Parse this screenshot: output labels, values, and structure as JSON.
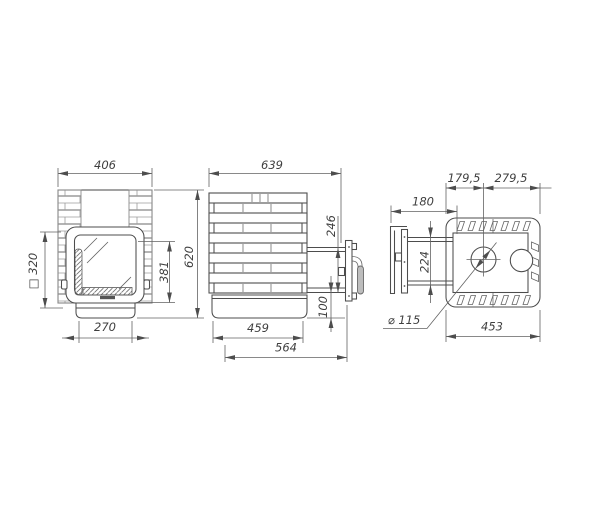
{
  "dims": {
    "front": {
      "width": "406",
      "opening": "□ 320",
      "door_height": "381",
      "height": "620",
      "base_width": "270"
    },
    "side": {
      "depth": "639",
      "tunnel_height": "246",
      "base_offset": "100",
      "base_depth": "459",
      "total_depth": "564"
    },
    "top": {
      "front_to_chimney": "179,5",
      "chimney_to_back": "279,5",
      "tunnel_length": "180",
      "tunnel_width": "224",
      "chimney_diameter": "⌀ 115",
      "width": "453"
    }
  }
}
